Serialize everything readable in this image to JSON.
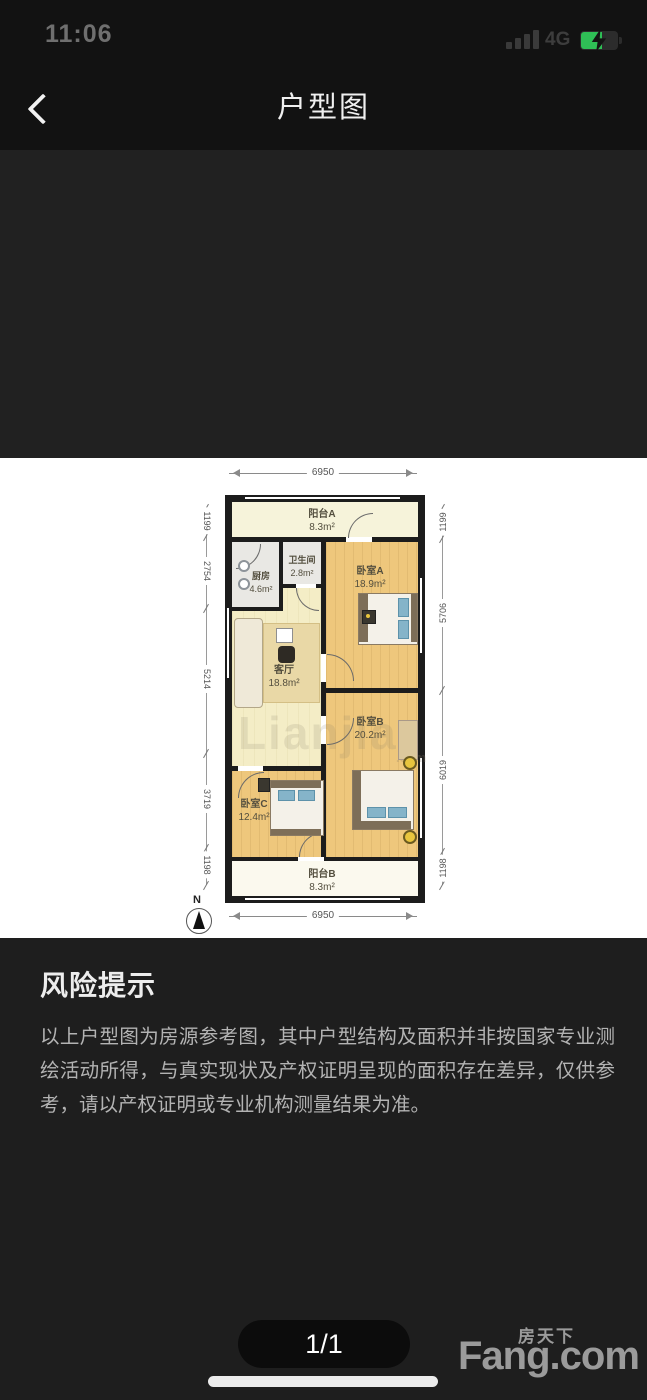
{
  "status_bar": {
    "time": "11:06",
    "network": "4G"
  },
  "header": {
    "title": "户型图"
  },
  "floor_plan": {
    "dim_top": "6950",
    "dim_bottom": "6950",
    "dims_left": [
      "1199",
      "2754",
      "5214",
      "3719",
      "1198"
    ],
    "dims_right": [
      "1199",
      "5706",
      "6019",
      "1198"
    ],
    "compass_label": "N",
    "watermark_big": "Lianjia",
    "watermark_small": ".com",
    "rooms": [
      {
        "name": "阳台A",
        "area": "8.3m²"
      },
      {
        "name": "卫生间",
        "area": "2.8m²"
      },
      {
        "name": "厨房",
        "area": "4.6m²"
      },
      {
        "name": "卧室A",
        "area": "18.9m²"
      },
      {
        "name": "客厅",
        "area": "18.8m²"
      },
      {
        "name": "卧室B",
        "area": "20.2m²"
      },
      {
        "name": "卧室C",
        "area": "12.4m²"
      },
      {
        "name": "阳台B",
        "area": "8.3m²"
      }
    ]
  },
  "risk": {
    "title": "风险提示",
    "body": "以上户型图为房源参考图，其中户型结构及面积并非按国家专业测绘活动所得，与真实现状及产权证明呈现的面积存在差异，仅供参考，请以产权证明或专业机构测量结果为准。"
  },
  "footer": {
    "page_indicator": "1/1",
    "brand_cn": "房天下",
    "brand_en": "Fang.com"
  },
  "colors": {
    "battery_green": "#2fbf56",
    "bedroom_floor": "#eec77c",
    "living_floor": "#f4edc6",
    "service_floor": "#e9e8e4",
    "balcony_floor": "#f6f3da",
    "wall": "#1c1c1c",
    "page_background": "#151515"
  }
}
